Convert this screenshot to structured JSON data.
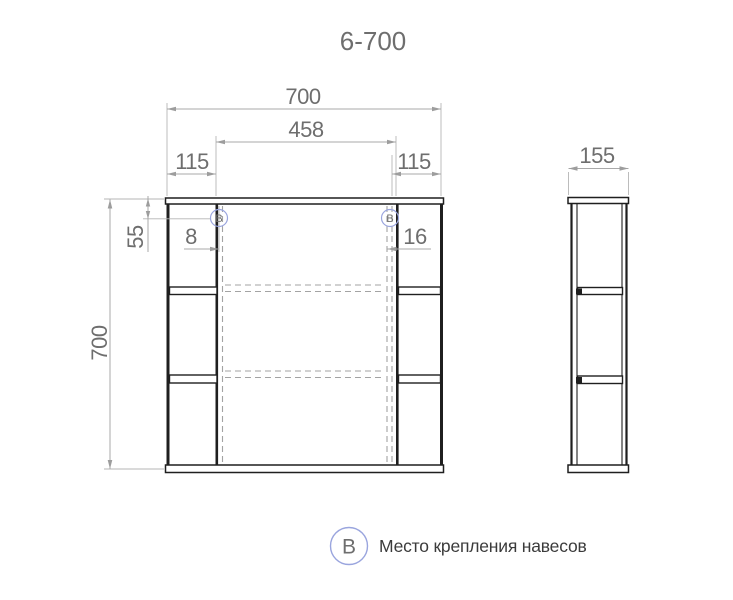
{
  "title": "6-700",
  "colors": {
    "accent": "#5567c8",
    "accent_light": "#9aa5de",
    "line": "#1f1f1f",
    "dim_line": "#a9a9a9",
    "dim_text": "#6e6e6e",
    "caption_text": "#3b3b3b"
  },
  "front_view": {
    "dims": {
      "overall_width": "700",
      "door_width": "458",
      "left_section_width": "115",
      "right_section_width": "115",
      "overall_height": "700",
      "hinge_top_offset": "55",
      "hinge_left_offset": "8",
      "hinge_right_offset": "16"
    }
  },
  "side_view": {
    "dims": {
      "depth": "155"
    }
  },
  "markers": {
    "letter": "В"
  },
  "legend": {
    "marker_letter": "В",
    "caption": "Место крепления навесов"
  }
}
